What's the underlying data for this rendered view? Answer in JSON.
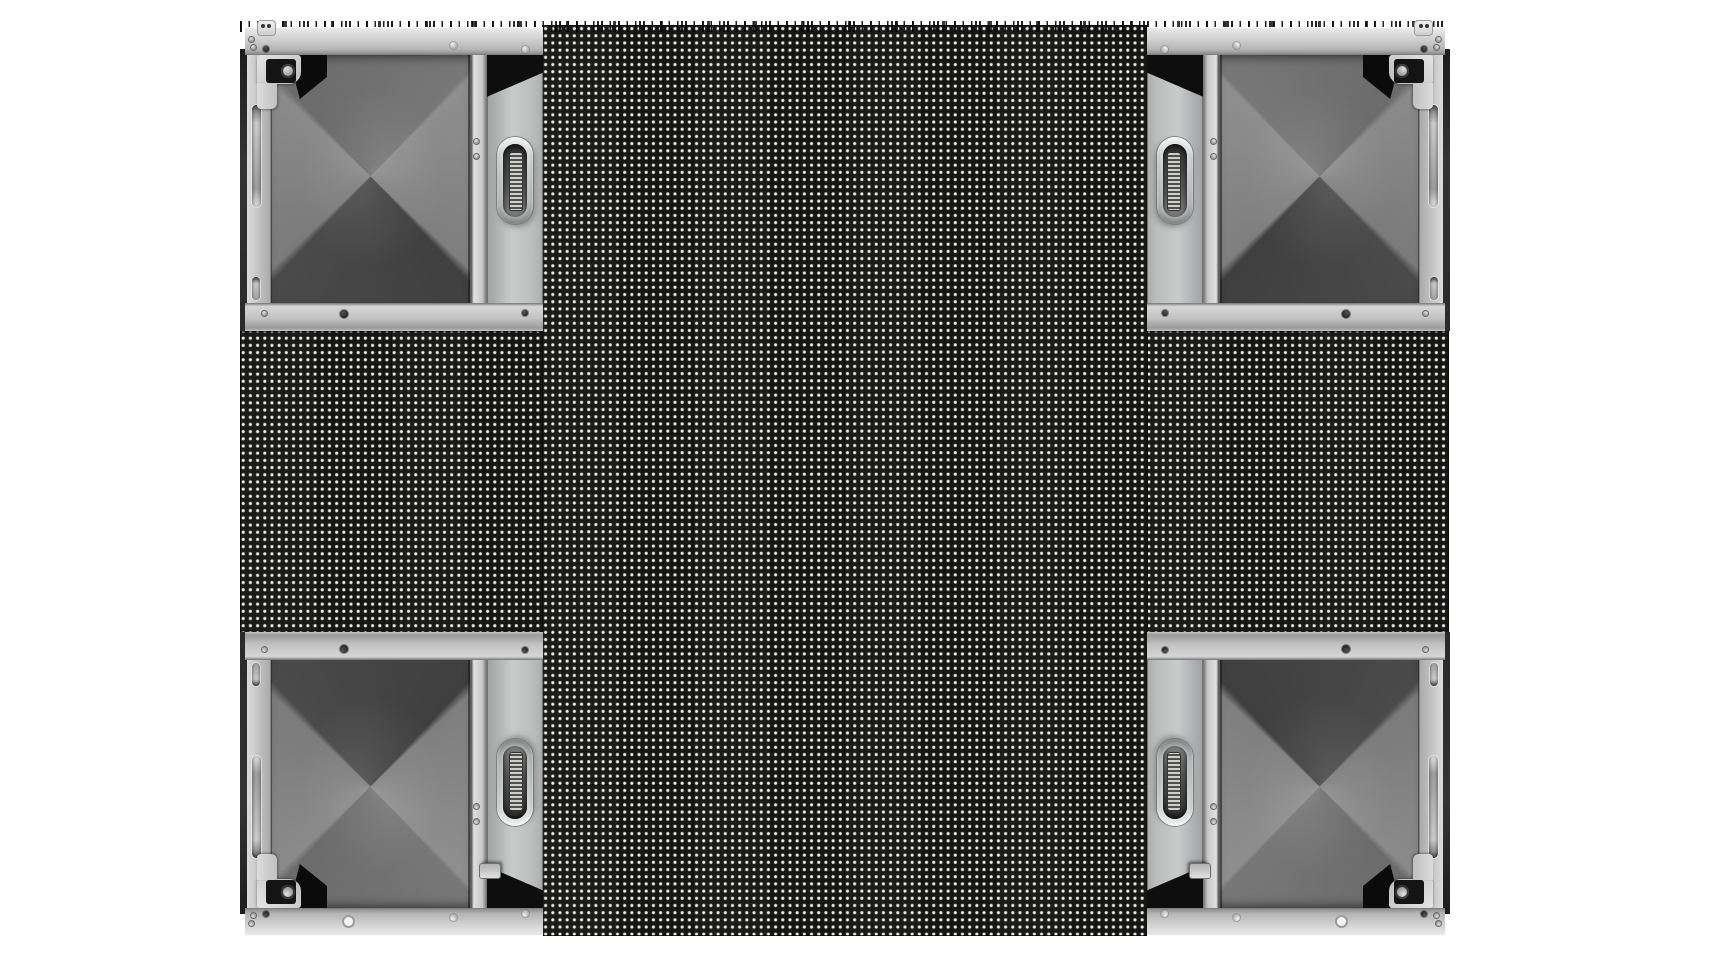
{
  "meta": {
    "title": "LED display cabinet product render",
    "background_color": "#ffffff",
    "contains_text": false
  },
  "scene": {
    "description": "Front view of a modular LED video wall; four corner cabinet frames are empty showing internal structure, LED pixel modules form a cross shape",
    "wall_grid": {
      "columns": 4,
      "rows": 3,
      "cabinet_size_px": 302
    },
    "colors": {
      "frame_light": "#c9c9c9",
      "frame_mid": "#9a9a9a",
      "frame_dark_edge": "#2a2a2a",
      "interior_dark_facet": "#454545",
      "led_base": "#161616",
      "led_pixel": "#f2f1e8",
      "shadow_black": "#0e0e0e",
      "background": "#ffffff"
    },
    "led": {
      "pixel_pitch_px": 7.2,
      "module_seam_pitch_px": 151.1,
      "bands": [
        {
          "name": "led-band-vertical",
          "x": 542,
          "y": 25,
          "width": 606,
          "height": 911
        },
        {
          "name": "led-band-horizontal",
          "x": 240,
          "y": 331,
          "width": 1209,
          "height": 303
        }
      ]
    },
    "fringe": {
      "name": "louver-fringe",
      "x": 240,
      "y": 21,
      "width": 1209,
      "height": 11
    },
    "cabinets": [
      {
        "name": "cabinet-frame-top-left",
        "x": 240,
        "y": 27,
        "flip_x": false,
        "flip_y": false
      },
      {
        "name": "cabinet-frame-top-right",
        "x": 1147,
        "y": 27,
        "flip_x": true,
        "flip_y": false
      },
      {
        "name": "cabinet-frame-bottom-left",
        "x": 240,
        "y": 632,
        "flip_x": false,
        "flip_y": true
      },
      {
        "name": "cabinet-frame-bottom-right",
        "x": 1147,
        "y": 632,
        "flip_x": true,
        "flip_y": true
      }
    ],
    "cabinet_parts": [
      "top-rail",
      "bottom-rail",
      "side-beam",
      "dark-side-edge",
      "vent-slot-long",
      "vent-slot-short",
      "frame-interior",
      "corner-lock-bracket",
      "lock-hub",
      "divider-bar",
      "module-mount-plate",
      "pull-handle",
      "handle-recess",
      "handle-connector",
      "screws",
      "top-tab",
      "rail-hole",
      "module-lock-tab"
    ],
    "counts": {
      "empty_frames": 4,
      "pull_handles": 4,
      "corner_locks": 4
    }
  }
}
